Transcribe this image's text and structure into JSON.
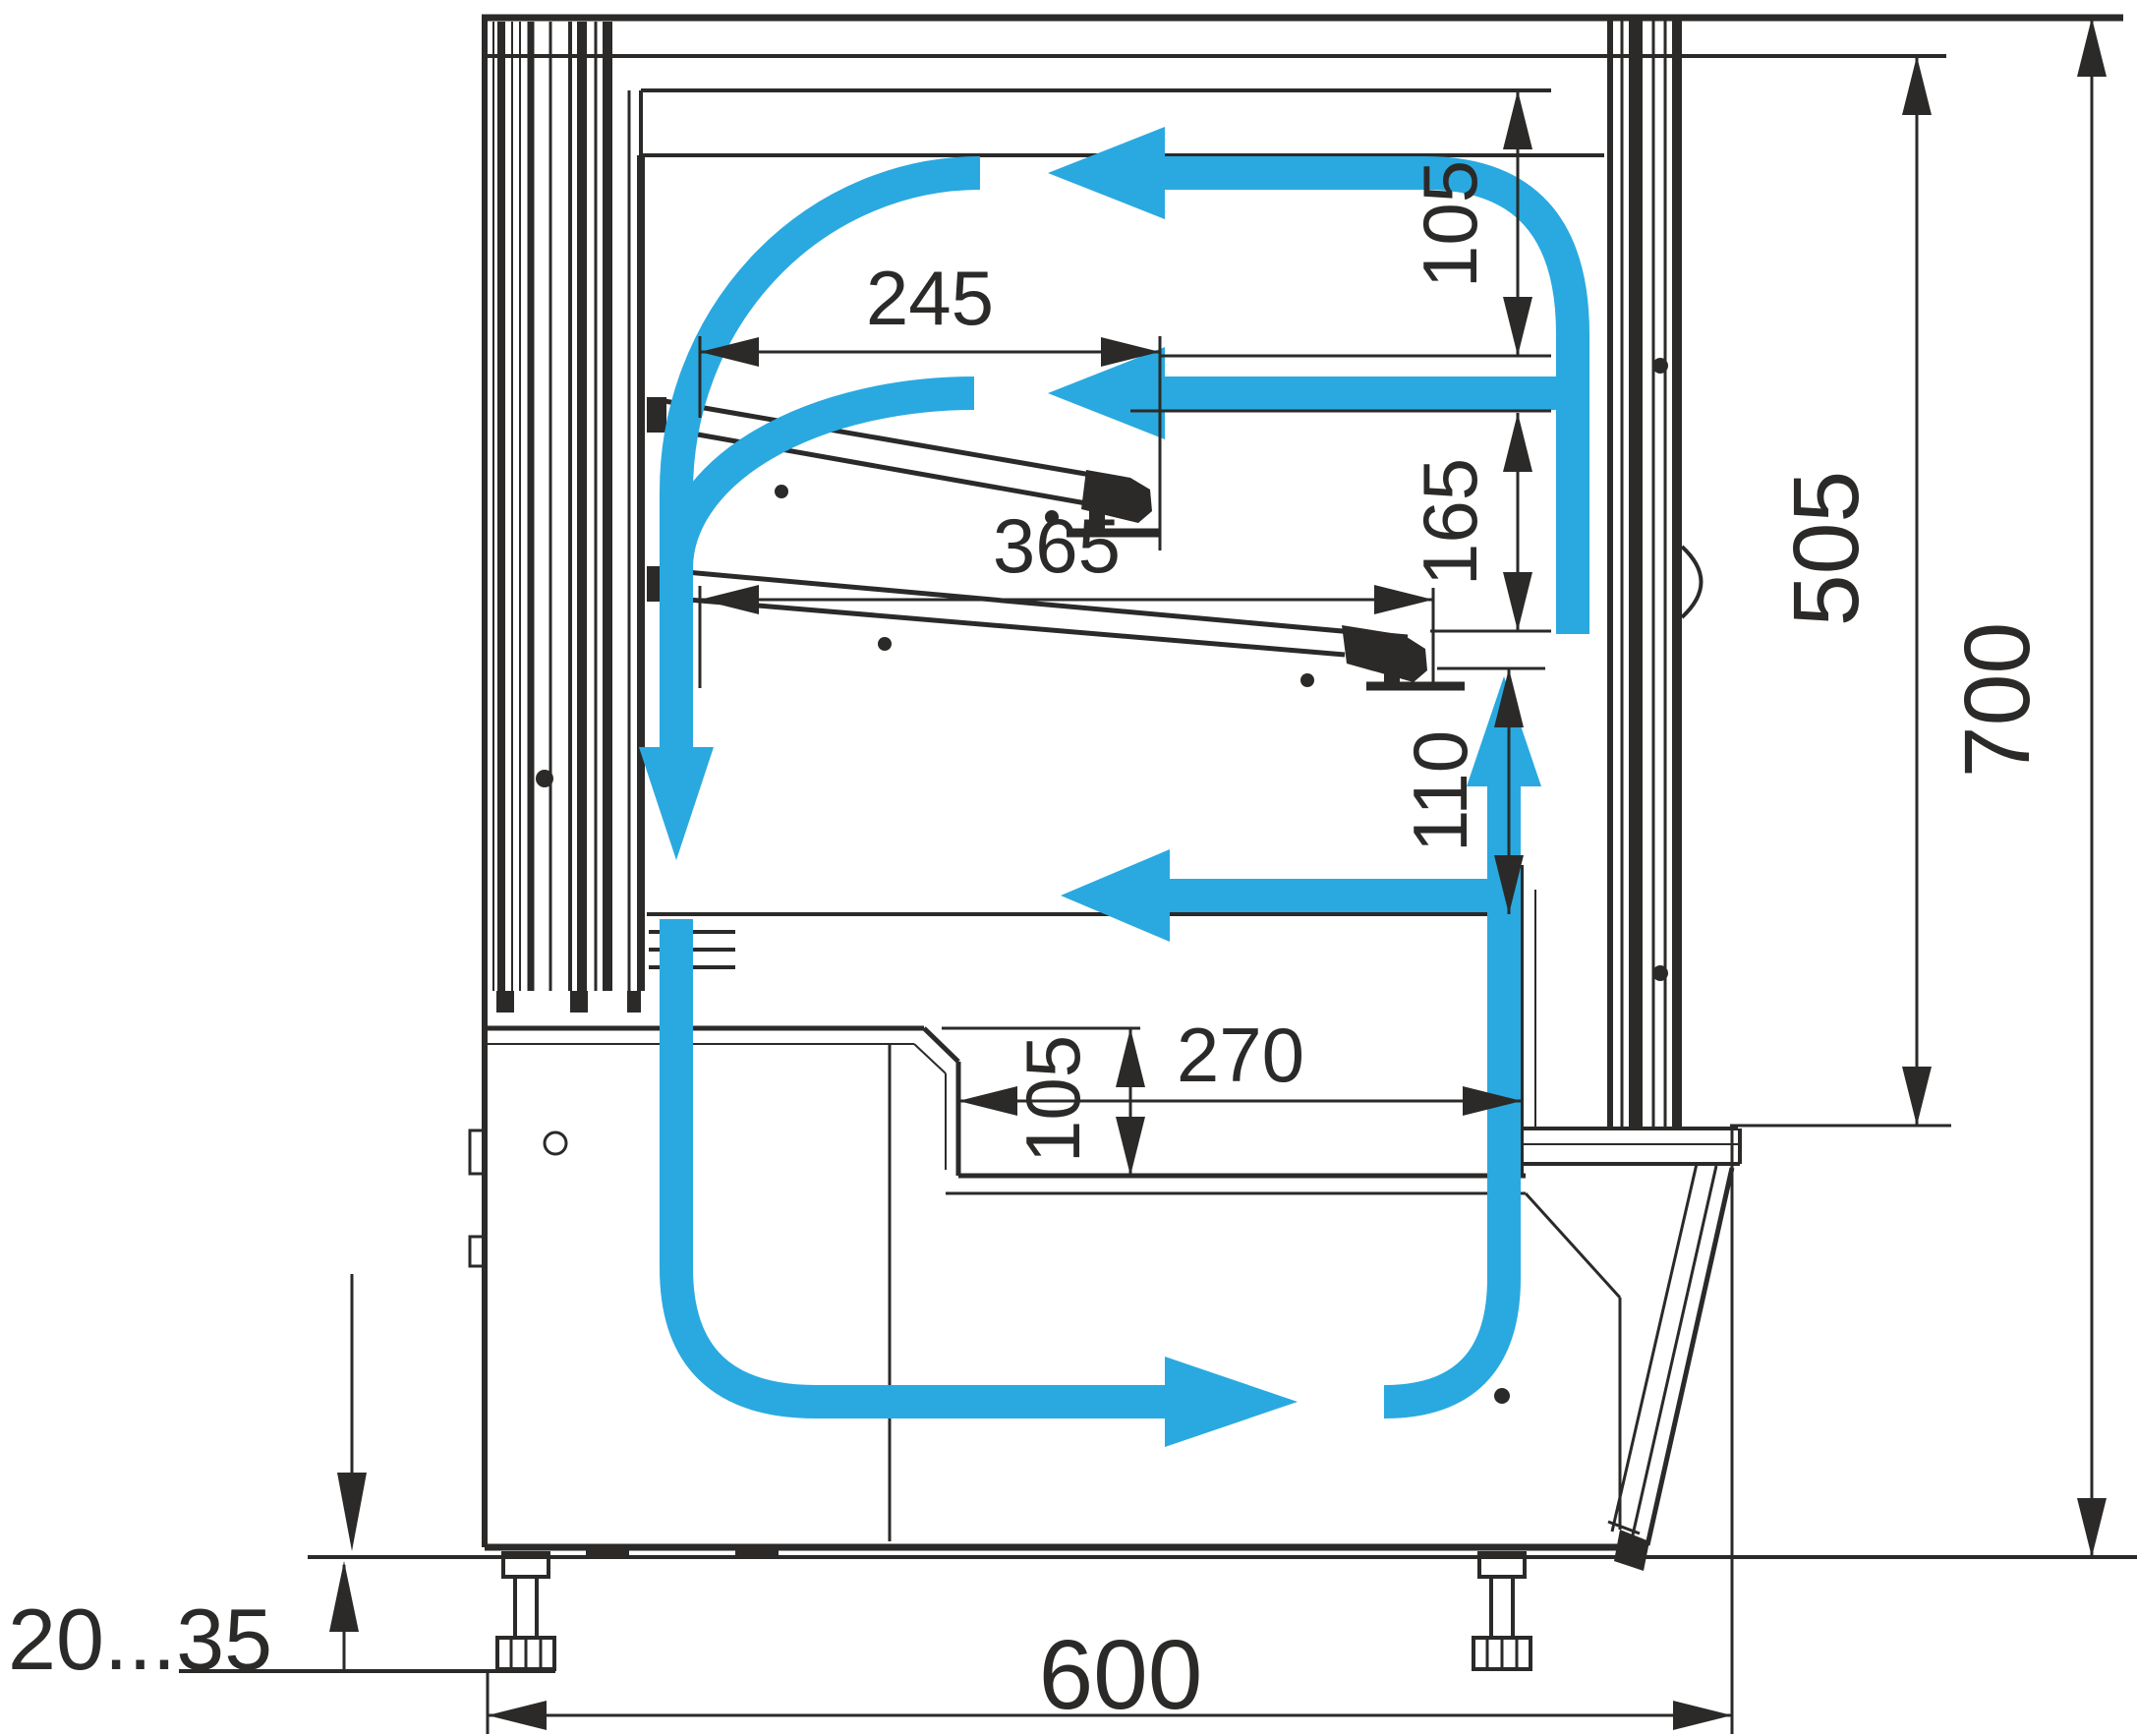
{
  "diagram": {
    "type": "technical-drawing",
    "subject": "refrigerated display case side cross-section with air circulation arrows",
    "colors": {
      "line": "#2B2A29",
      "airflow": "#29A9E0",
      "background": "#FFFFFF"
    },
    "units": "mm",
    "dims": {
      "shelf_upper_depth": "245",
      "shelf_lower_depth": "365",
      "canopy_to_shelf_gap": "105",
      "shelf_to_shelf_gap": "165",
      "shelf_to_deck_gap": "110",
      "well_depth": "105",
      "well_width": "270",
      "inner_height": "505",
      "overall_height": "700",
      "overall_depth": "600",
      "foot_adjust_range": "20...35"
    }
  }
}
